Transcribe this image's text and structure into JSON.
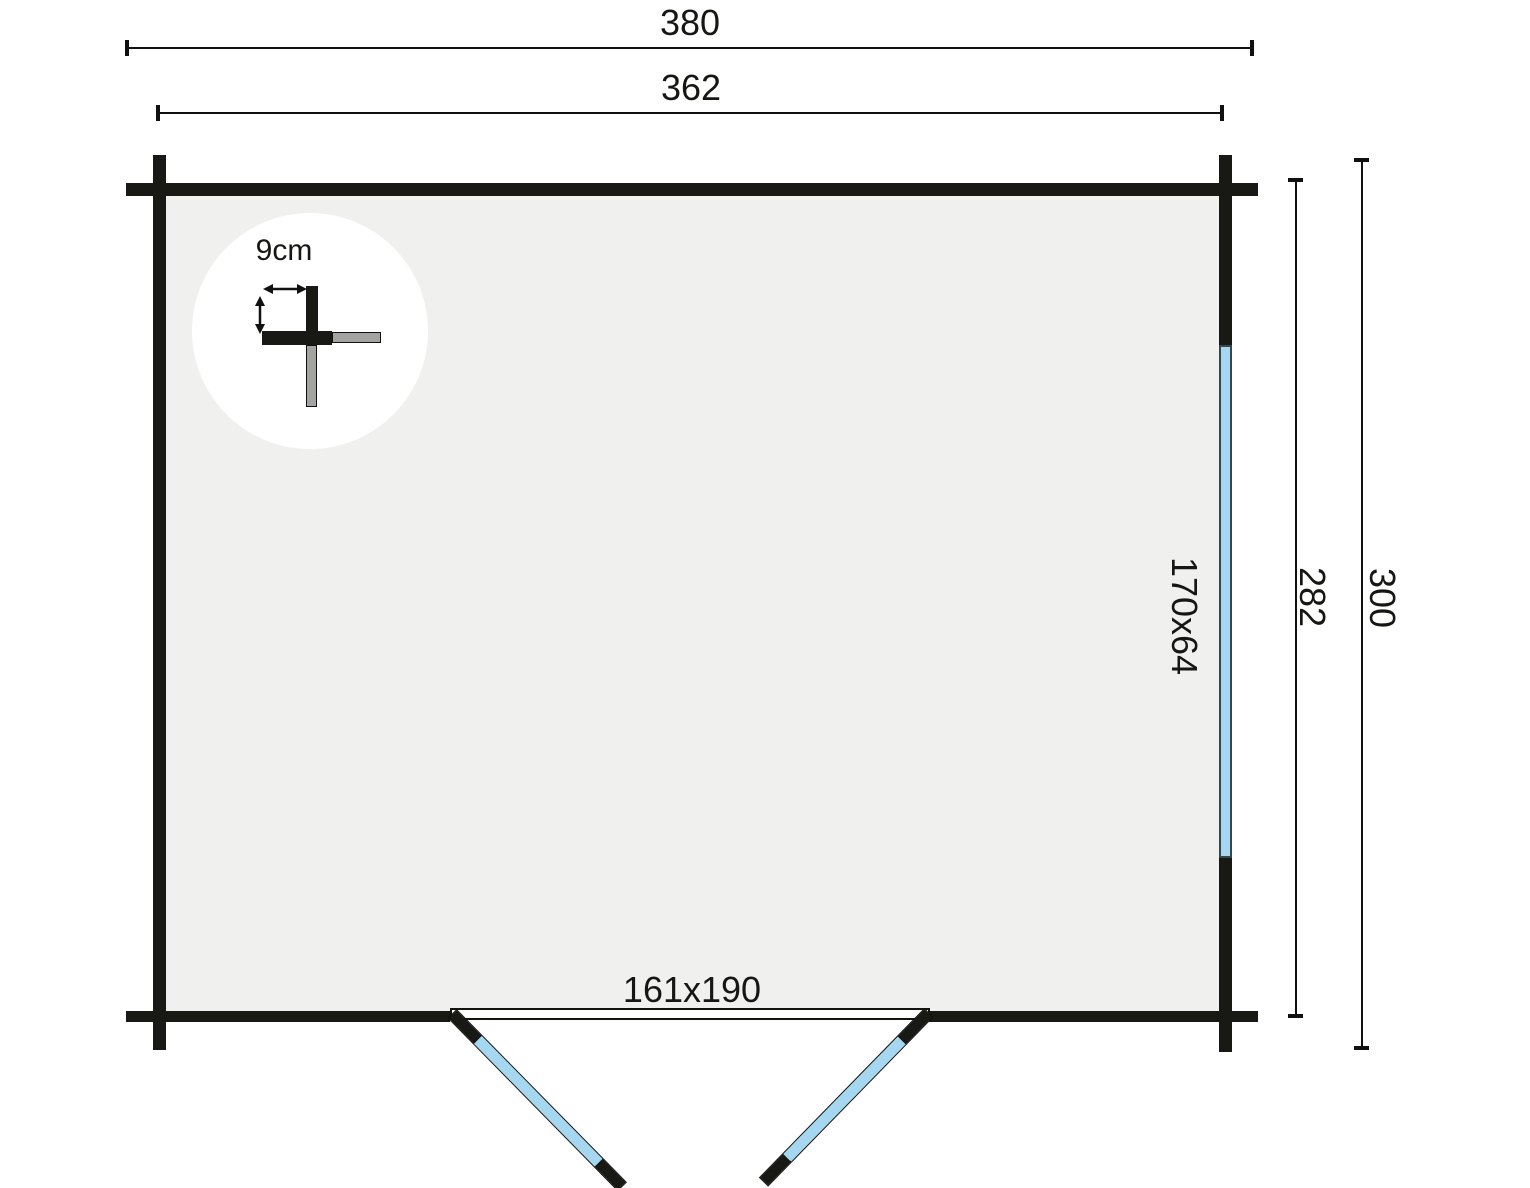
{
  "plan": {
    "dimensions": {
      "overall_width": "380",
      "inner_width": "362",
      "inner_depth": "282",
      "overall_depth": "300"
    },
    "labels": {
      "wall_thickness": "9cm",
      "window_size": "170x64",
      "door_size": "161x190"
    }
  },
  "colors": {
    "wall": "#181815",
    "floor": "#f0f0ee",
    "glazing": "#a5d7f0",
    "gray": "#a3a3a1",
    "line": "#111111"
  }
}
